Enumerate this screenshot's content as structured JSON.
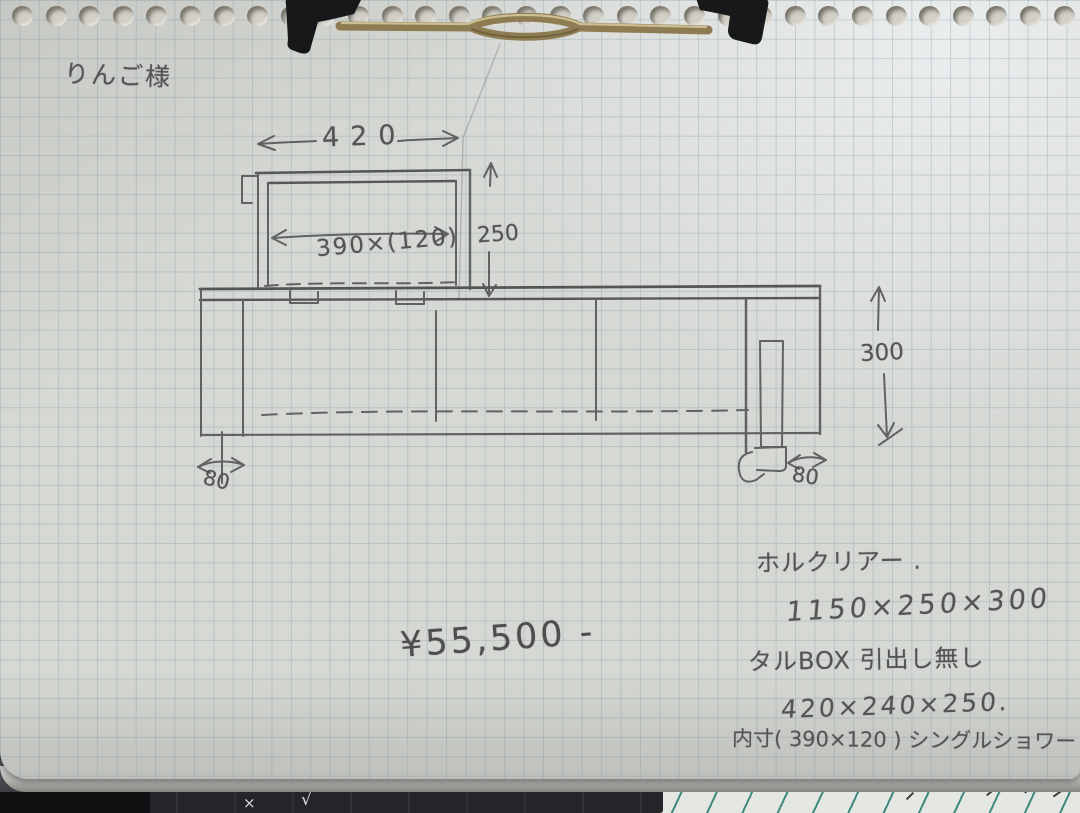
{
  "page": {
    "description": "handwritten furniture quote sketch on grid-paper clipboard"
  },
  "header": {
    "customer_name": "りんご様"
  },
  "sketch_dims": {
    "top_width": "420",
    "inner_size": "390×(120)",
    "box_height": "250",
    "board_height": "300",
    "left_foot": "80",
    "right_foot": "80"
  },
  "price": {
    "amount": "¥55,500 -"
  },
  "notes": {
    "line1": "ホルクリアー .",
    "line2": "1150×250×300",
    "line3": "タルBOX 引出し無し",
    "line4": "420×240×250.",
    "line5": "内寸( 390×120 ) シングルショワー"
  },
  "desk": {
    "mark1": "×",
    "mark2": "√"
  },
  "colors": {
    "paper": "#d6d8d4",
    "grid_line": "#7a92a2",
    "pencil": "#545456",
    "clip_plastic": "#17181a",
    "clip_wire": "#8e7c52",
    "teal_paper_line": "#3f8a7e"
  }
}
